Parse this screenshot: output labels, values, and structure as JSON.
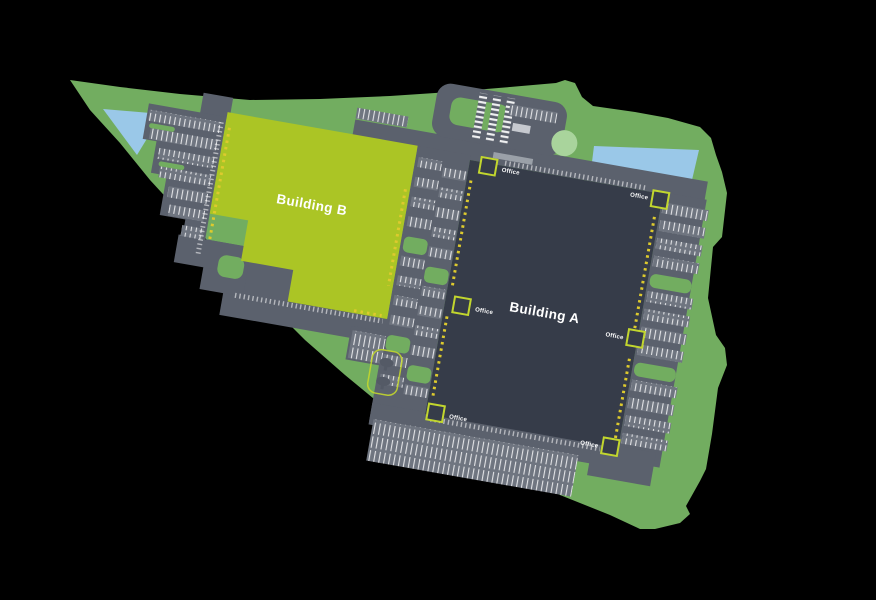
{
  "plan": {
    "buildings": [
      {
        "id": "building-a",
        "label": "Building A",
        "color": "#363c49"
      },
      {
        "id": "building-b",
        "label": "Building B",
        "color": "#abc525"
      }
    ],
    "offices": [
      {
        "label": "Office"
      },
      {
        "label": "Office"
      },
      {
        "label": "Office"
      },
      {
        "label": "Office"
      },
      {
        "label": "Office"
      },
      {
        "label": "Office"
      }
    ],
    "colors": {
      "background": "#000000",
      "landscape": "#72ad60",
      "road": "#5b616d",
      "parking_row": "#6f7580",
      "water": "#9ac8e8",
      "roundabout": "#a9d49c",
      "dock_doors": "#ddca2e",
      "office_outline": "#c2d62e",
      "marking": "#ffffff",
      "label_text": "#ffffff"
    }
  }
}
